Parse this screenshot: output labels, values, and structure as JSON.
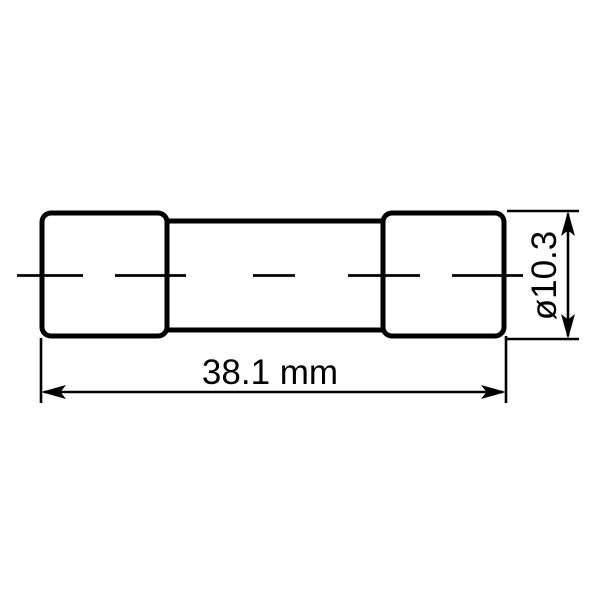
{
  "page": {
    "background": "#ffffff",
    "stroke_color": "#000000"
  },
  "diagram": {
    "type": "technical-drawing",
    "subject": "cartridge-fuse-side-view",
    "dimensions": {
      "length": {
        "label": "38.1 mm",
        "value": "38.1",
        "unit": "mm"
      },
      "diameter": {
        "label": "ø10.3",
        "value": "10.3",
        "symbol": "ø"
      }
    }
  }
}
